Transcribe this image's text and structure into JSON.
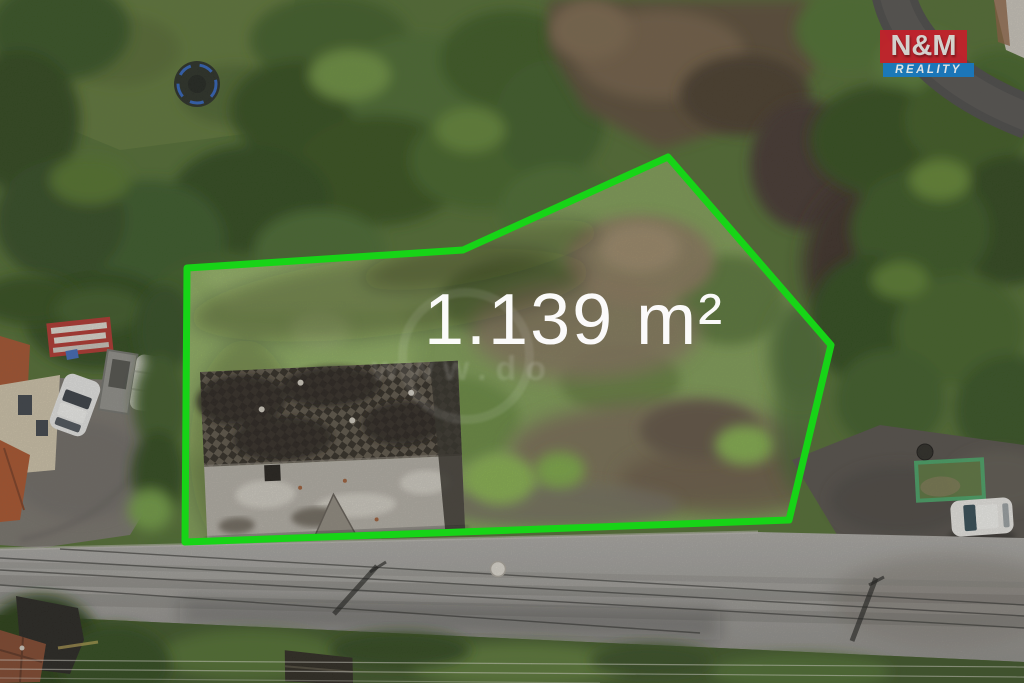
{
  "photo": {
    "area_label": "1.139 m²",
    "watermark_text": "www.do",
    "boundary": {
      "color": "#17d417",
      "points": "187,268 463,250 668,157 831,345 789,520 185,542"
    },
    "logo": {
      "line1": "N&M",
      "line2": "REALITY",
      "red": "#c5202b",
      "blue": "#187ac2"
    }
  }
}
